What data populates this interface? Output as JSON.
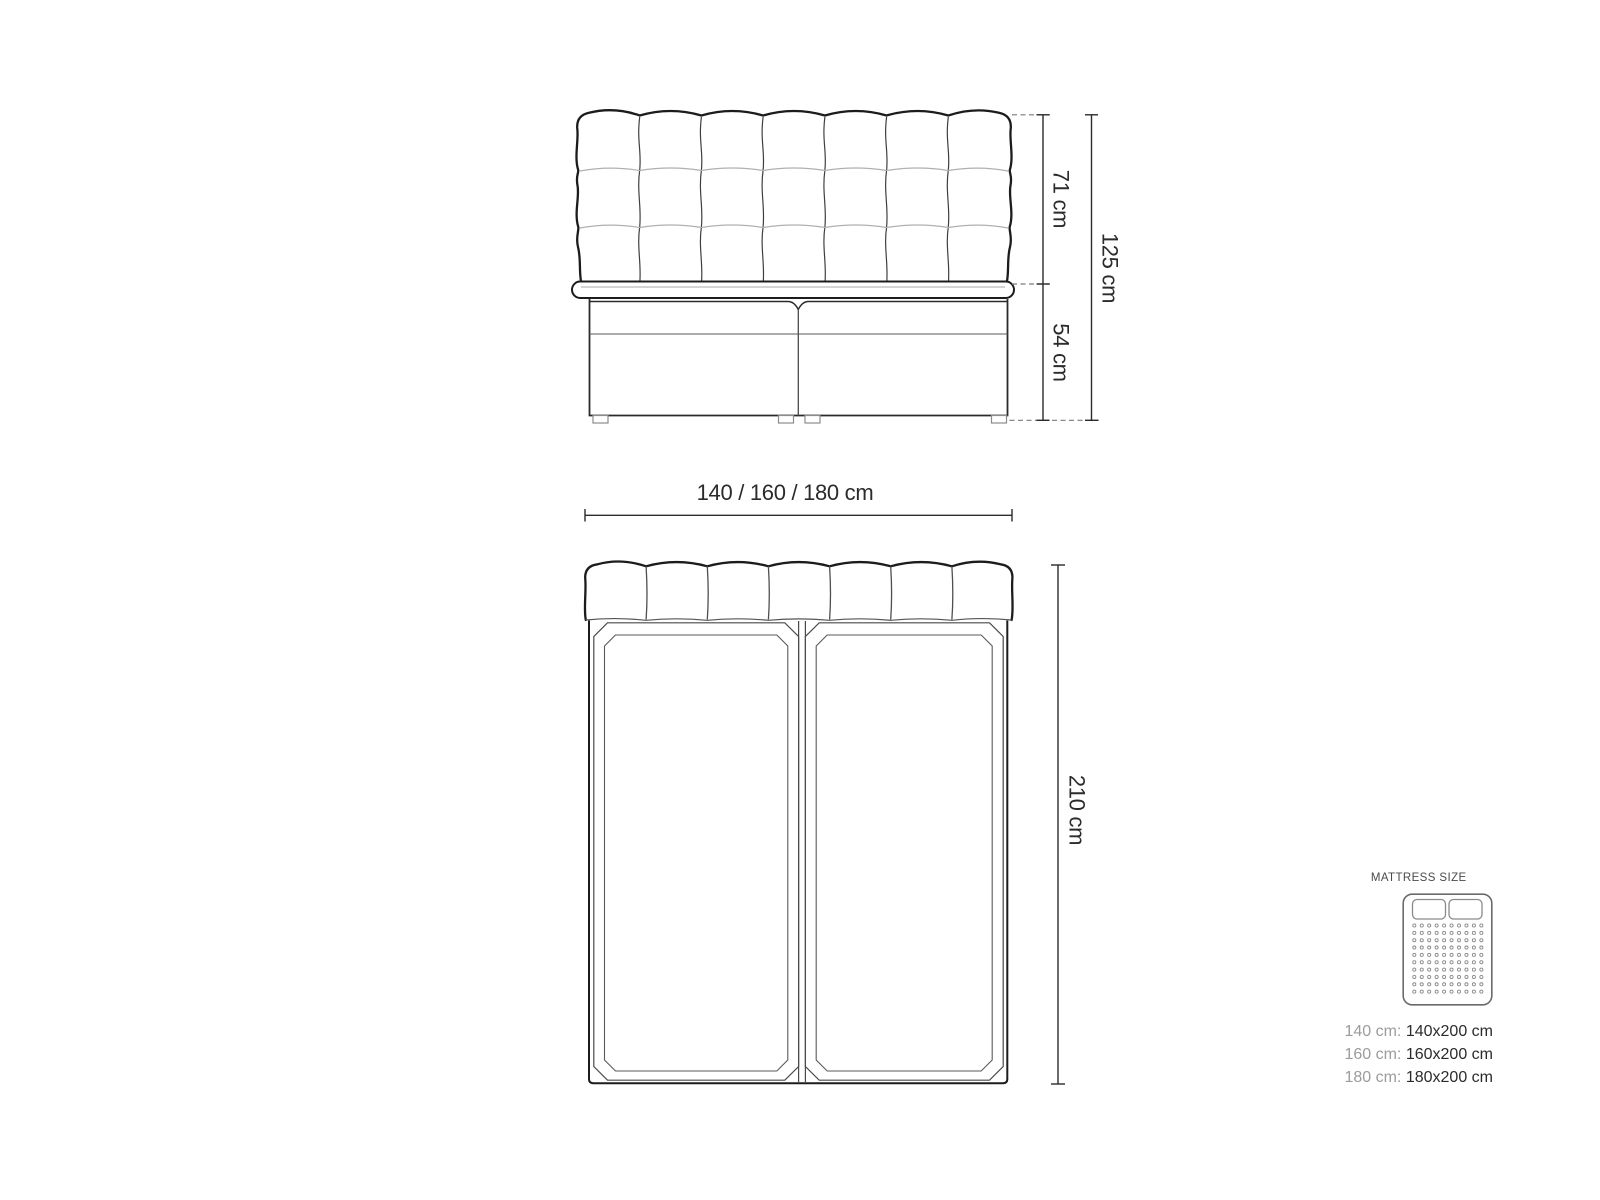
{
  "front_view": {
    "dim_headboard_height": "71 cm",
    "dim_base_height": "54 cm",
    "dim_total_height": "125 cm"
  },
  "width_dimension": {
    "label": "140 / 160 / 180 cm"
  },
  "plan_view": {
    "dim_length": "210 cm"
  },
  "legend": {
    "title": "MATTRESS SIZE",
    "sizes": [
      {
        "label": "140 cm:",
        "value": "140x200 cm"
      },
      {
        "label": "160 cm:",
        "value": "160x200 cm"
      },
      {
        "label": "180 cm:",
        "value": "180x200 cm"
      }
    ]
  },
  "icons": {
    "legend_icon": "mattress-top-view-icon"
  },
  "colors": {
    "outline": "#1c1c1c",
    "detail_line": "#555555",
    "light_seam": "#b0b0b0",
    "dimension": "#2b2b2b",
    "dashed_extension": "#7a7a7a",
    "legend_title": "#4a4a4a",
    "legend_label": "#9c9c9c",
    "legend_value": "#2b2b2b",
    "background": "#ffffff"
  }
}
